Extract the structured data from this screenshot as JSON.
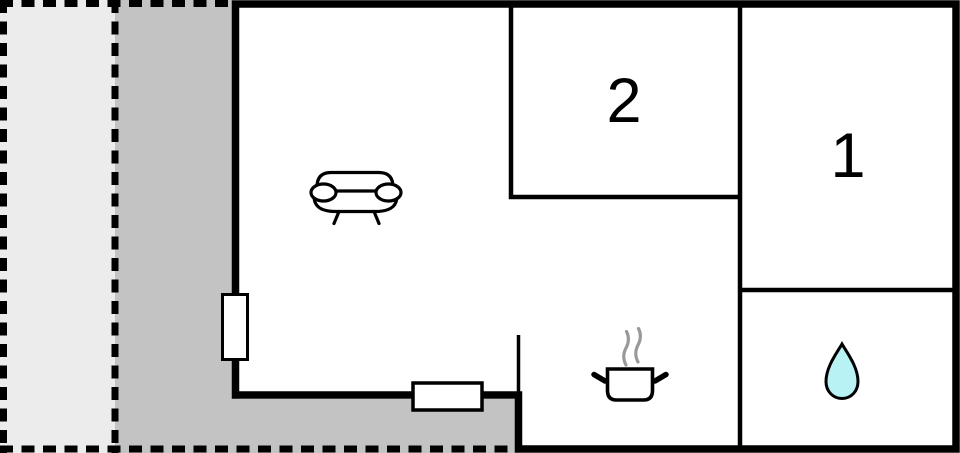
{
  "floorplan": {
    "rooms": {
      "bedroom_2_label": "2",
      "bedroom_1_label": "1"
    },
    "icons": [
      "sofa-icon",
      "cooking-pot-icon",
      "steam-icon",
      "water-drop-icon"
    ],
    "colors": {
      "terrace_light": "#ececec",
      "terrace_dark": "#c3c3c3",
      "wall": "#000000",
      "interior": "#ffffff",
      "water_drop": "#b9f2f4",
      "steam": "#999999",
      "label_text": "#000000"
    }
  }
}
